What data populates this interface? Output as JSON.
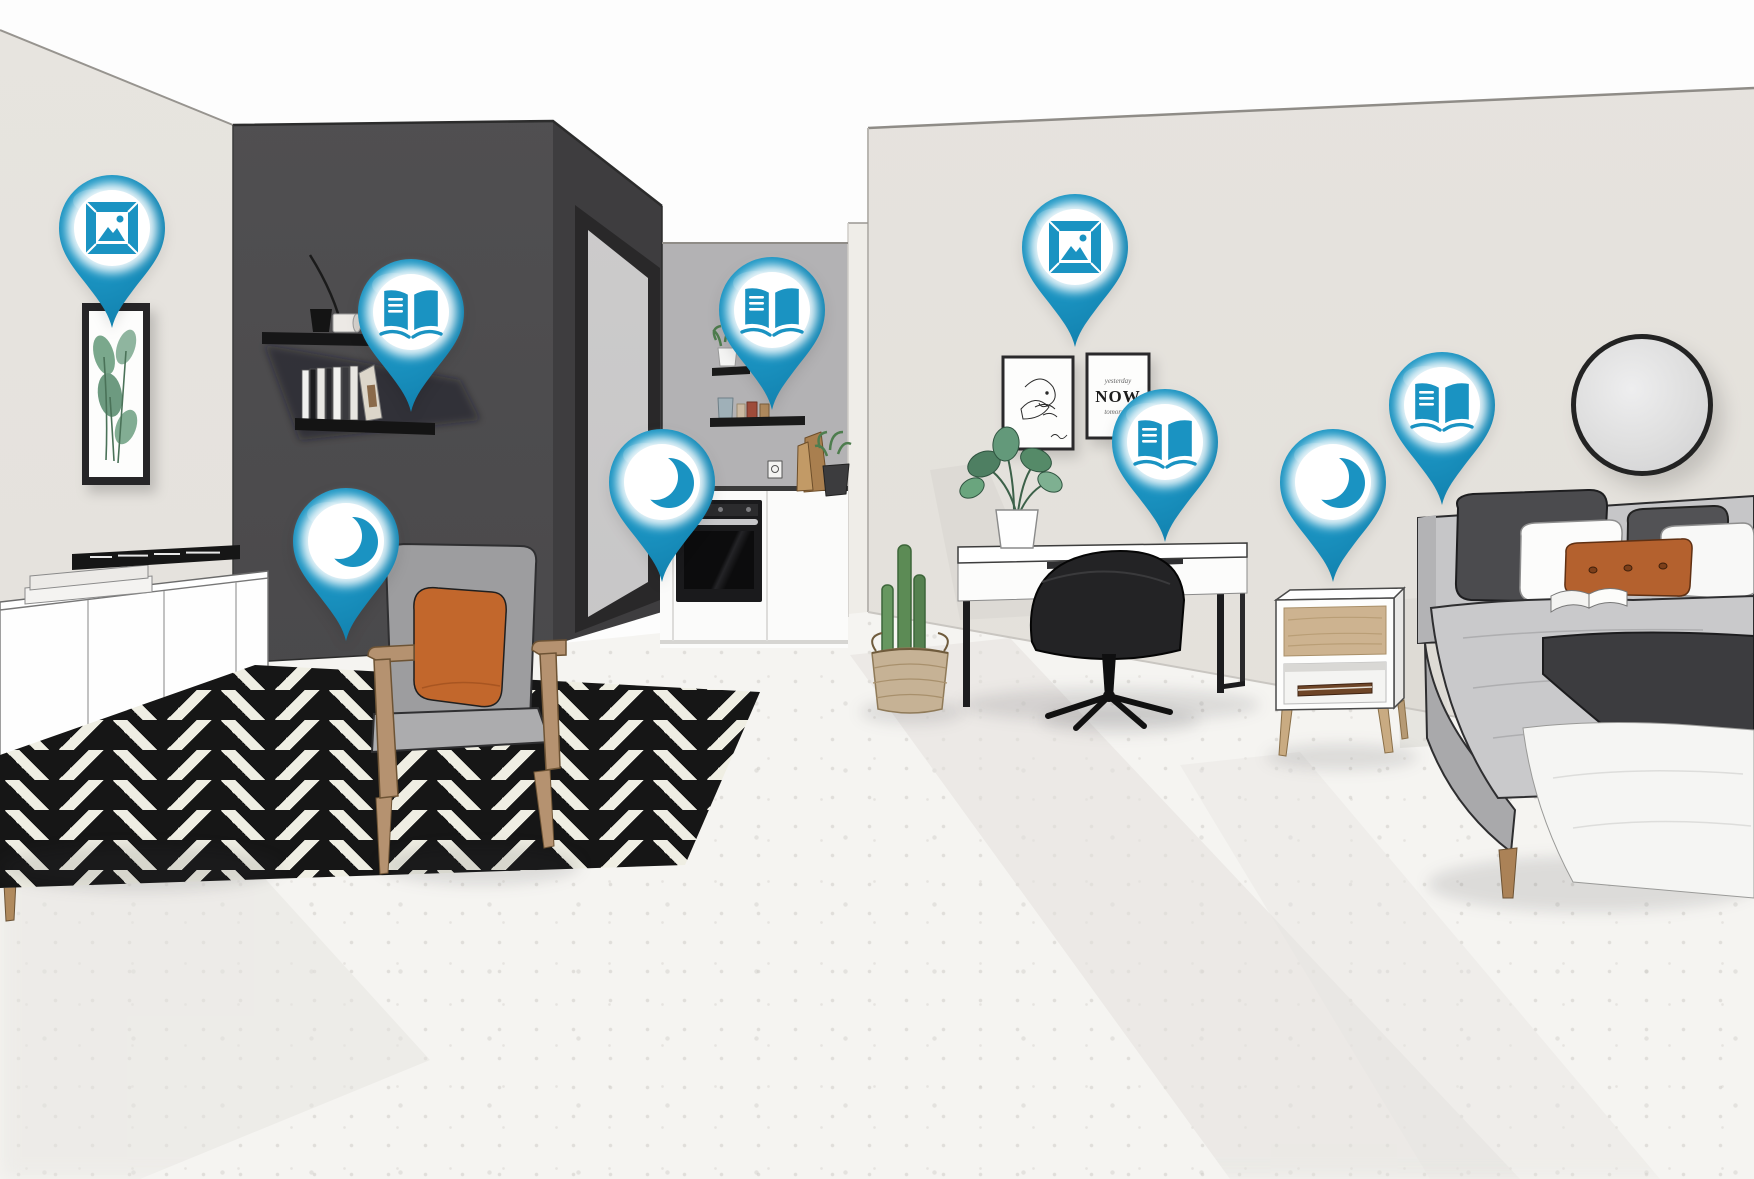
{
  "app": {
    "name": "interactive-room-hotspots",
    "view": "isometric-apartment-illustration"
  },
  "colors": {
    "pin_teal": "#1b94c2",
    "pin_icon": "#1a93c2",
    "wall_light": "#e5e2dd",
    "wall_dark": "#4b4a4c",
    "wall_kitchen_grey": "#b3b2b4",
    "floor": "#f5f4f1",
    "rug_black": "#161616",
    "rug_cream": "#efeee3",
    "accent_orange_chair": "#c2672c",
    "accent_orange_bed": "#b4612e",
    "wood": "#b59270"
  },
  "pins": [
    {
      "id": "pin-picture-living",
      "icon": "picture-frame-icon",
      "x": 112,
      "y": 228
    },
    {
      "id": "pin-book-shelf",
      "icon": "open-book-icon",
      "x": 411,
      "y": 312
    },
    {
      "id": "pin-moon-living",
      "icon": "moon-icon",
      "x": 346,
      "y": 541
    },
    {
      "id": "pin-book-kitchen",
      "icon": "open-book-icon",
      "x": 772,
      "y": 310
    },
    {
      "id": "pin-moon-kitchen",
      "icon": "moon-icon",
      "x": 662,
      "y": 482
    },
    {
      "id": "pin-picture-workspace",
      "icon": "picture-frame-icon",
      "x": 1075,
      "y": 247
    },
    {
      "id": "pin-book-workspace",
      "icon": "open-book-icon",
      "x": 1165,
      "y": 442
    },
    {
      "id": "pin-moon-bedroom",
      "icon": "moon-icon",
      "x": 1333,
      "y": 482
    },
    {
      "id": "pin-book-bedroom",
      "icon": "open-book-icon",
      "x": 1442,
      "y": 405
    }
  ],
  "poster": {
    "line1": "yesterday",
    "line2": "NOW",
    "line3": "tomorrow"
  },
  "scene": {
    "areas": [
      "living-area",
      "kitchenette",
      "workspace",
      "bedroom"
    ],
    "furniture": [
      "sideboard",
      "wall-art",
      "wall-shelves",
      "armchair",
      "chevron-rug",
      "kitchen-counter",
      "oven",
      "desk",
      "office-chair",
      "monstera-plant",
      "cactus-basket",
      "gallery-frames",
      "round-mirror",
      "nightstand",
      "bed"
    ]
  }
}
